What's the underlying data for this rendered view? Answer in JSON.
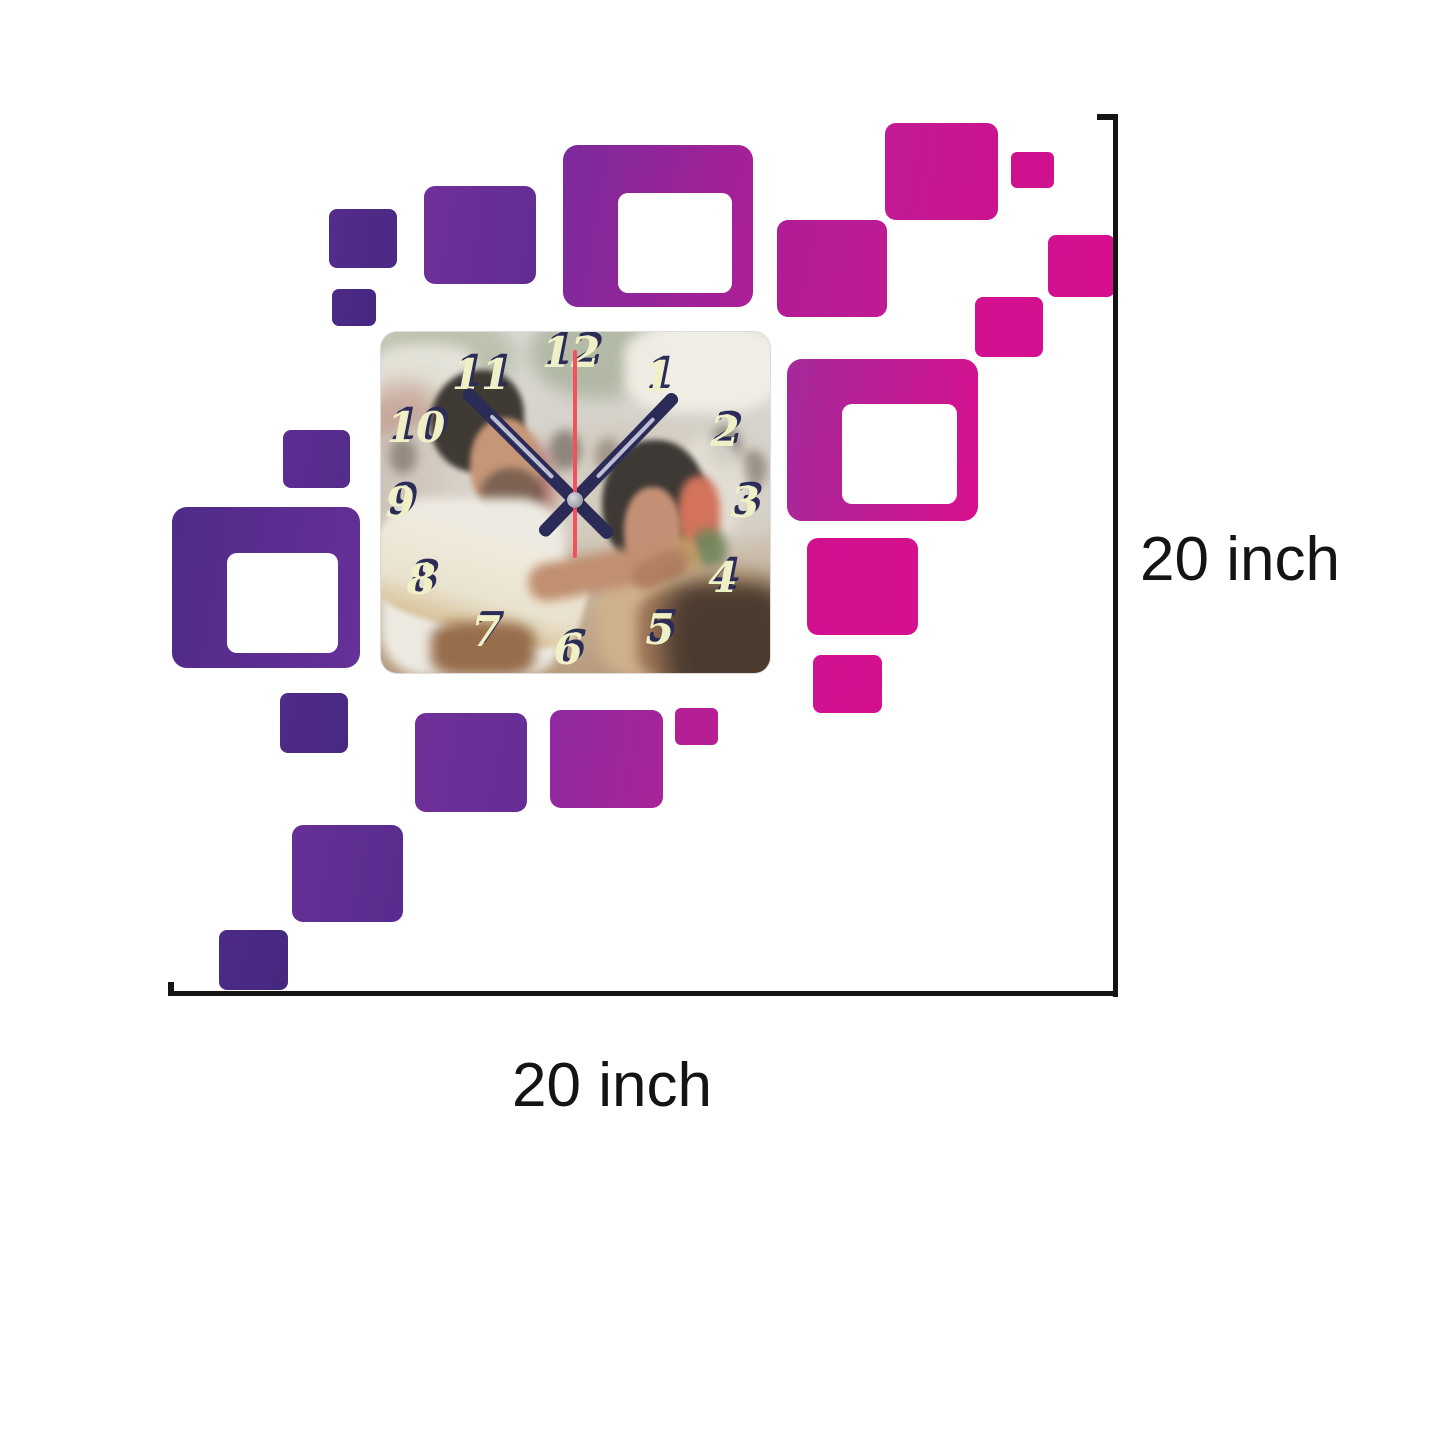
{
  "product": {
    "name": "Square photo wall clock with decorative wall squares",
    "scene": "Wedding couple photo clock face: groom in white kerala attire adorning bride in beige bridal dress with flowers in hair, blurred crowd behind"
  },
  "dimensions": {
    "height_label": "20 inch",
    "width_label": "20 inch"
  },
  "palette": {
    "dimension_line_color": "#141414",
    "label_color": "#141414",
    "numeral_color": "#eff0c6",
    "numeral_shadow": "#2b2c58",
    "hand_color": "#2b2b57",
    "second_hand_color": "#f4505e",
    "purple_dark": "#4c2a86",
    "purple_mid": "#6f3099",
    "magenta": "#a82398",
    "pink": "#d4108f"
  },
  "clock": {
    "numerals": [
      {
        "v": "12",
        "x": 48.8,
        "y": 6.2
      },
      {
        "v": "1",
        "x": 71.2,
        "y": 13.2
      },
      {
        "v": "2",
        "x": 88.4,
        "y": 29.3
      },
      {
        "v": "3",
        "x": 93.6,
        "y": 50.1
      },
      {
        "v": "4",
        "x": 87.9,
        "y": 72.1
      },
      {
        "v": "5",
        "x": 71.7,
        "y": 87.4
      },
      {
        "v": "6",
        "x": 48.1,
        "y": 93.3
      },
      {
        "v": "7",
        "x": 27.0,
        "y": 88.0
      },
      {
        "v": "8",
        "x": 10.3,
        "y": 72.7
      },
      {
        "v": "9",
        "x": 4.9,
        "y": 50.1
      },
      {
        "v": "10",
        "x": 9.0,
        "y": 28.2
      },
      {
        "v": "11",
        "x": 25.7,
        "y": 12.6
      }
    ],
    "hands": {
      "hour_angle_deg": -45,
      "minute_angle_deg": 44,
      "second_angle_deg": 0
    }
  },
  "decor_squares": [
    {
      "x": 329,
      "y": 209,
      "w": 68,
      "h": 59,
      "r": 8,
      "c1": "#542c8c",
      "c2": "#4a2983"
    },
    {
      "x": 424,
      "y": 186,
      "w": 112,
      "h": 98,
      "r": 11,
      "c1": "#703099",
      "c2": "#612d92"
    },
    {
      "x": 332,
      "y": 289,
      "w": 44,
      "h": 37,
      "r": 7,
      "c1": "#4c2a86",
      "c2": "#452881"
    },
    {
      "x": 563,
      "y": 145,
      "w": 190,
      "h": 162,
      "r": 15,
      "c1": "#7b2b9c",
      "c2": "#ad1e97",
      "hole": {
        "dx": 55,
        "dy": 48,
        "w": 114,
        "h": 100,
        "r": 10
      }
    },
    {
      "x": 777,
      "y": 220,
      "w": 110,
      "h": 97,
      "r": 11,
      "c1": "#b01d95",
      "c2": "#c01a93"
    },
    {
      "x": 885,
      "y": 123,
      "w": 113,
      "h": 97,
      "r": 11,
      "c1": "#c01b94",
      "c2": "#cc128f"
    },
    {
      "x": 1011,
      "y": 152,
      "w": 43,
      "h": 36,
      "r": 6,
      "c1": "#cf1190",
      "c2": "#d0118f"
    },
    {
      "x": 1048,
      "y": 235,
      "w": 67,
      "h": 62,
      "r": 8,
      "c1": "#d41090",
      "c2": "#d50f8e"
    },
    {
      "x": 975,
      "y": 297,
      "w": 68,
      "h": 60,
      "r": 8,
      "c1": "#d11190",
      "c2": "#d40f8f"
    },
    {
      "x": 787,
      "y": 359,
      "w": 191,
      "h": 162,
      "r": 15,
      "c1": "#a42a9b",
      "c2": "#d80f8e",
      "hole": {
        "dx": 55,
        "dy": 45,
        "w": 115,
        "h": 100,
        "r": 10
      }
    },
    {
      "x": 807,
      "y": 538,
      "w": 111,
      "h": 97,
      "r": 11,
      "c1": "#d2118f",
      "c2": "#d60f8e"
    },
    {
      "x": 813,
      "y": 655,
      "w": 69,
      "h": 58,
      "r": 8,
      "c1": "#cf1290",
      "c2": "#d50f8e"
    },
    {
      "x": 283,
      "y": 430,
      "w": 67,
      "h": 58,
      "r": 8,
      "c1": "#5e2d92",
      "c2": "#532c8a"
    },
    {
      "x": 172,
      "y": 507,
      "w": 188,
      "h": 161,
      "r": 15,
      "c1": "#4f2b88",
      "c2": "#663098",
      "hole": {
        "dx": 55,
        "dy": 46,
        "w": 111,
        "h": 100,
        "r": 10
      }
    },
    {
      "x": 280,
      "y": 693,
      "w": 68,
      "h": 60,
      "r": 8,
      "c1": "#502b88",
      "c2": "#482982"
    },
    {
      "x": 415,
      "y": 713,
      "w": 112,
      "h": 99,
      "r": 11,
      "c1": "#703099",
      "c2": "#652e94"
    },
    {
      "x": 550,
      "y": 710,
      "w": 113,
      "h": 98,
      "r": 11,
      "c1": "#8f2aa0",
      "c2": "#a82398"
    },
    {
      "x": 675,
      "y": 708,
      "w": 43,
      "h": 37,
      "r": 6,
      "c1": "#b22096",
      "c2": "#b81d94"
    },
    {
      "x": 292,
      "y": 825,
      "w": 111,
      "h": 97,
      "r": 11,
      "c1": "#663096",
      "c2": "#572c8d"
    },
    {
      "x": 219,
      "y": 930,
      "w": 69,
      "h": 60,
      "r": 8,
      "c1": "#4d2a86",
      "c2": "#452880"
    }
  ]
}
